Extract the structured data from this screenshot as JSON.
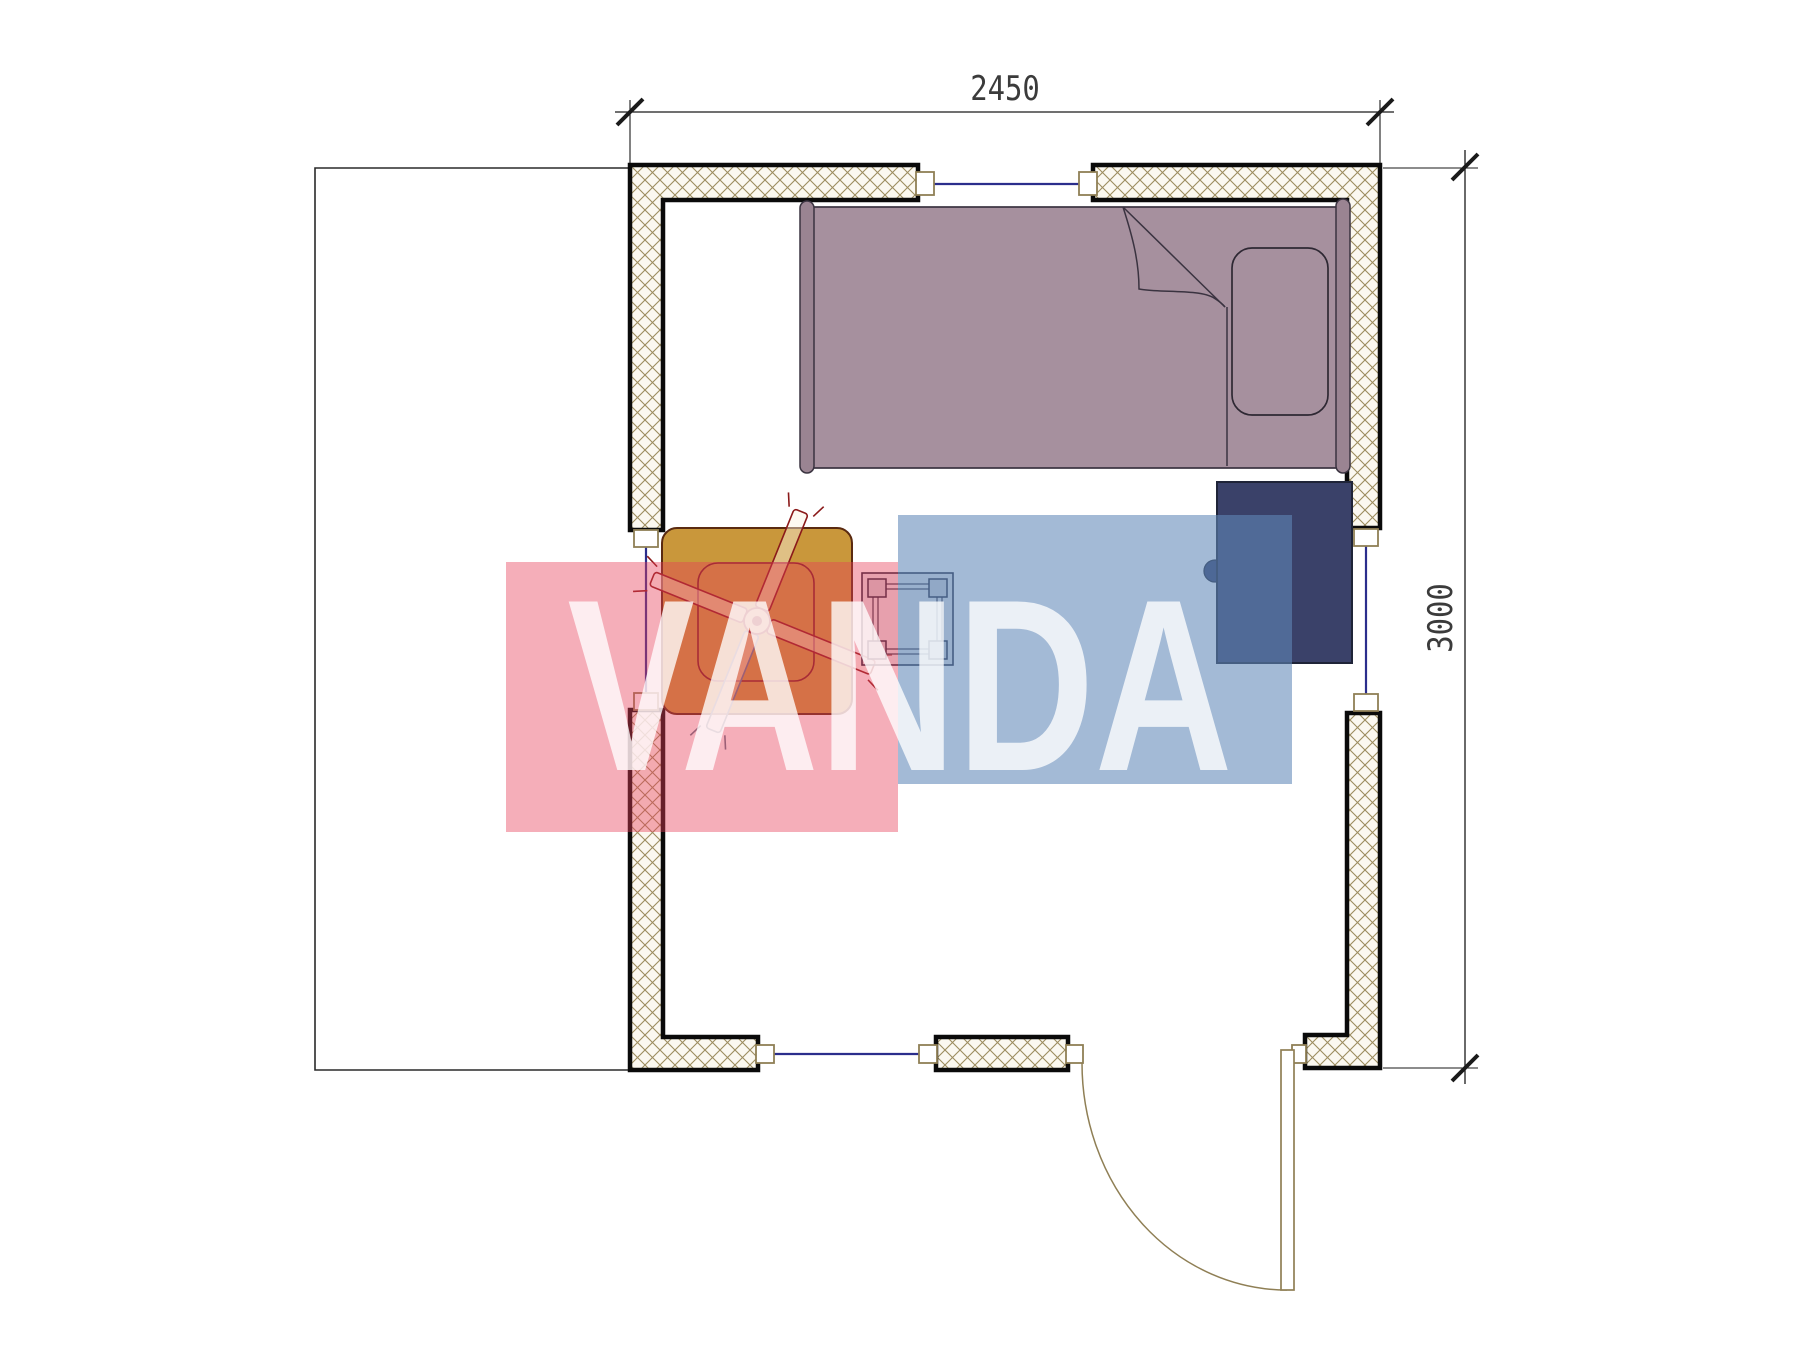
{
  "plan": {
    "type": "floor-plan",
    "room_width_mm": "2450",
    "room_height_mm": "3000"
  },
  "dimensions": {
    "width_label": "2450",
    "height_label": "3000"
  },
  "watermark": {
    "text": "VANDA",
    "red_color": "#E83E59",
    "blue_color": "#6088B8",
    "text_color": "rgba(255,255,255,0.78)"
  },
  "icons": {
    "bed": "bed-symbol",
    "pillow": "pillow-symbol",
    "blanket_fold": "blanket-fold-symbol",
    "cabinet": "nightstand-symbol",
    "table": "table-symbol",
    "fan": "ceiling-fan-symbol",
    "stool": "stool-symbol",
    "door": "door-swing-symbol",
    "window": "window-symbol"
  },
  "colors": {
    "wall_fill": "#FBF8F0",
    "wall_hatch": "#9C8C5E",
    "wall_border": "#0A0A0A",
    "window_line": "#2B2E8C",
    "window_jamb_border": "#8F7F55",
    "bed_fill": "#A6909E",
    "bed_outline": "#3A3340",
    "cabinet_fill": "#3A4169",
    "table_fill": "#C9973B",
    "fan_outline": "#8B1A1A",
    "fan_gray_blade": "#66788C",
    "stool_outline": "#23233A",
    "door_line": "#8F7F55",
    "porch_line": "#2A2A2A",
    "dimension_line": "#1A1A1A"
  }
}
